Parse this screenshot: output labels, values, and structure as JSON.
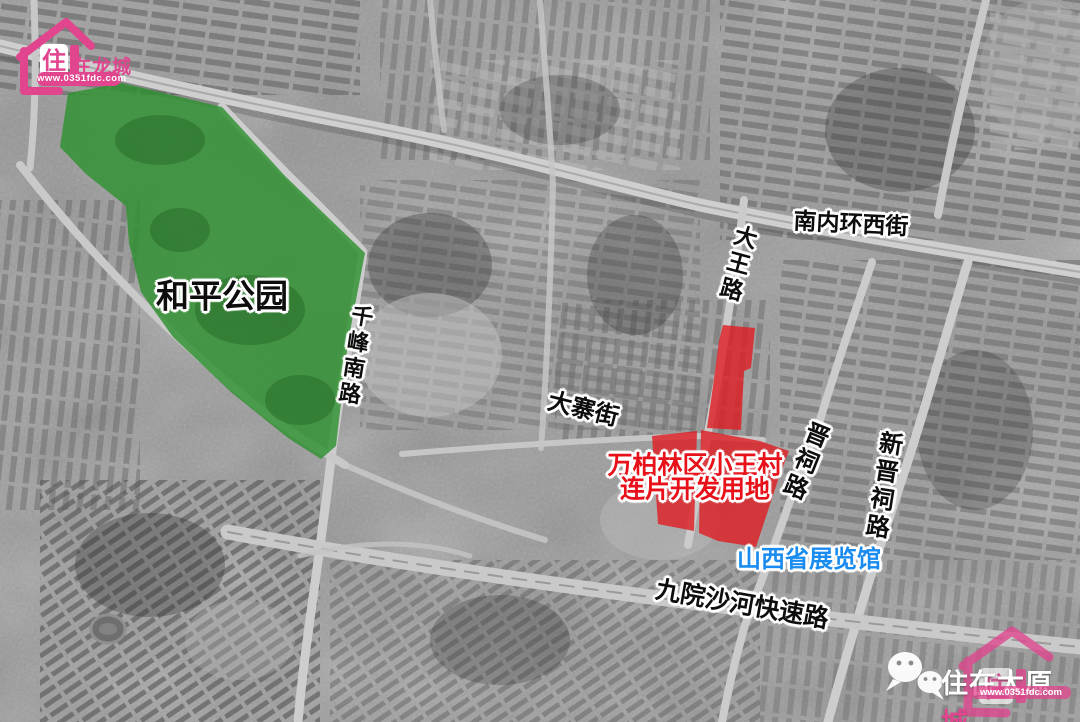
{
  "map": {
    "labels": {
      "park": "和平公园",
      "dev_line1": "万柏林区小王村",
      "dev_line2": "连片开发用地",
      "exhibition_hall": "山西省展览馆"
    },
    "roads": {
      "nanneihuan_xijie": "南内环西街",
      "dawang_lu": "大王路",
      "qianfeng_nanlu": "千峰南路",
      "dazhai_jie": "大寨街",
      "jinci_lu": "晋祠路",
      "xin_jinci_lu": "新晋祠路",
      "jiuyuan_shahe_expwy": "九院沙河快速路"
    },
    "colors": {
      "park_green": "#2f9132",
      "development_red": "#e01d22",
      "label_red": "#e8111a",
      "poi_blue": "#1a8cf0",
      "brand_pink": "#e0458e"
    }
  },
  "brand": {
    "house_char": "住",
    "name_suffix": "在龙城",
    "url": "www.0351fdc.com"
  },
  "watermark": {
    "account_name_main": "住在太原",
    "account_name_accent": "城",
    "url": "www.0351fdc.com"
  },
  "icons": {
    "wechat": "wechat-icon",
    "house_logo": "house-logo-icon"
  }
}
